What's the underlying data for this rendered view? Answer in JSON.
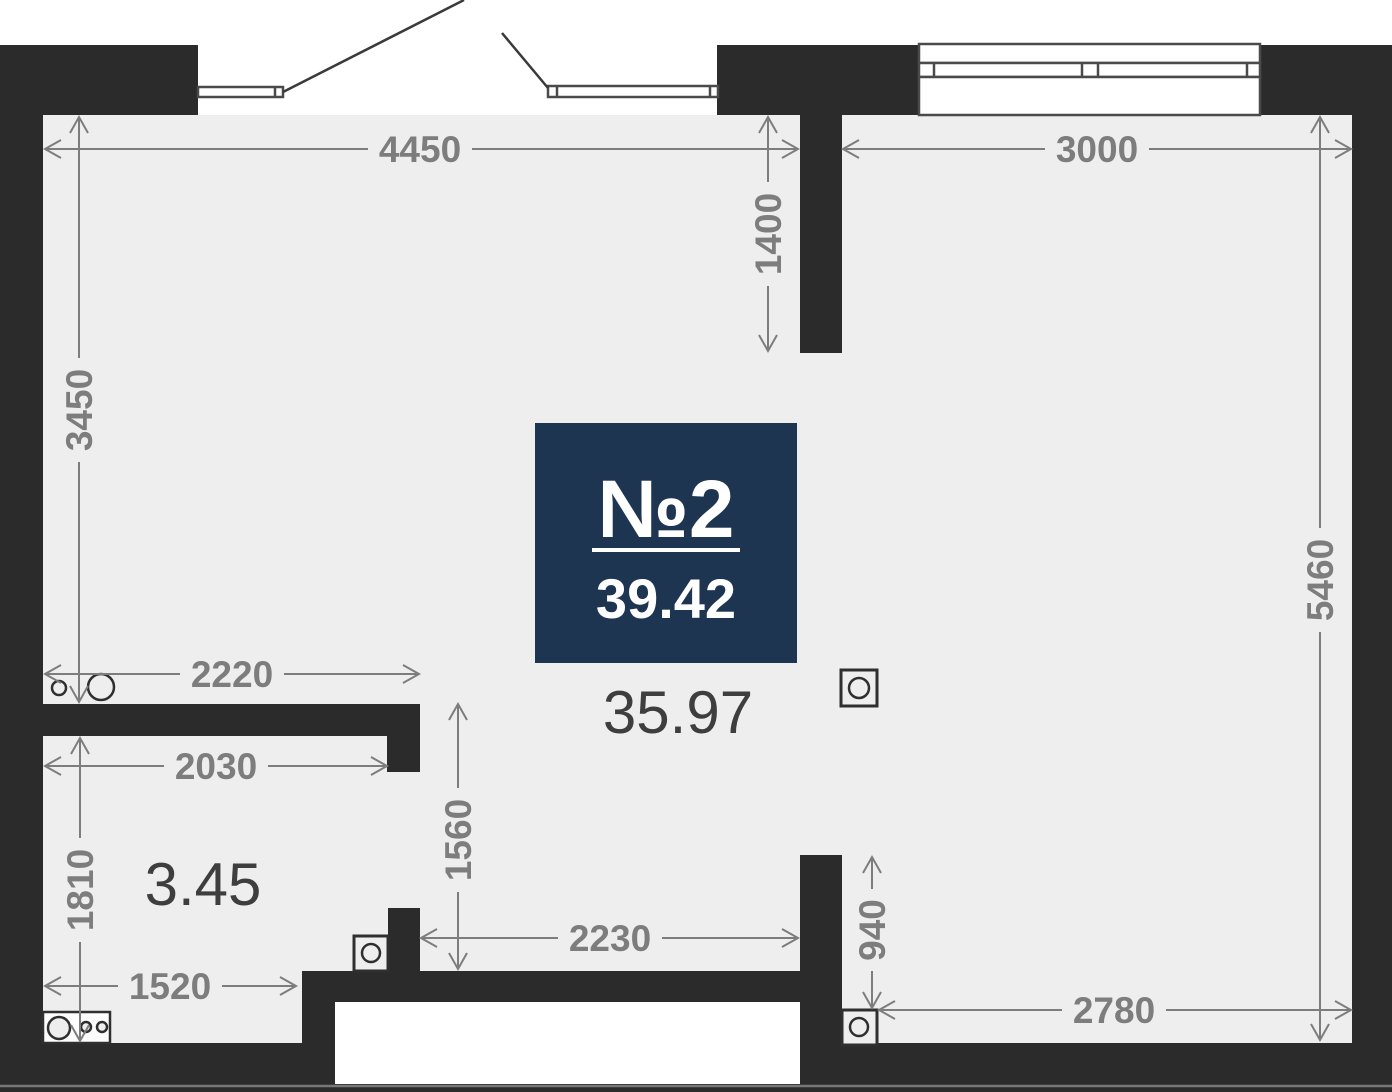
{
  "badge": {
    "unit_number": "№2",
    "unit_area": "39.42"
  },
  "room_areas": {
    "main": "35.97",
    "bathroom": "3.45"
  },
  "dimensions": {
    "top_left": "4450",
    "top_right": "3000",
    "entry_depth": "1400",
    "left_height": "3450",
    "right_height": "5460",
    "bath_top_width": "2220",
    "bath_width": "2030",
    "bath_height": "1810",
    "corridor_height": "1560",
    "corridor_width": "2230",
    "bath_bottom_width": "1520",
    "right_stub_height": "940",
    "bottom_right_width": "2780"
  },
  "colors": {
    "wall": "#2b2b2b",
    "floor": "#eeeeef",
    "dimension": "#7d7d7d",
    "outline": "#3f3f3f",
    "badge_bg": "#1e3552",
    "badge_text": "#ffffff",
    "area_text": "#3e3e3e",
    "page": "#ffffff"
  }
}
